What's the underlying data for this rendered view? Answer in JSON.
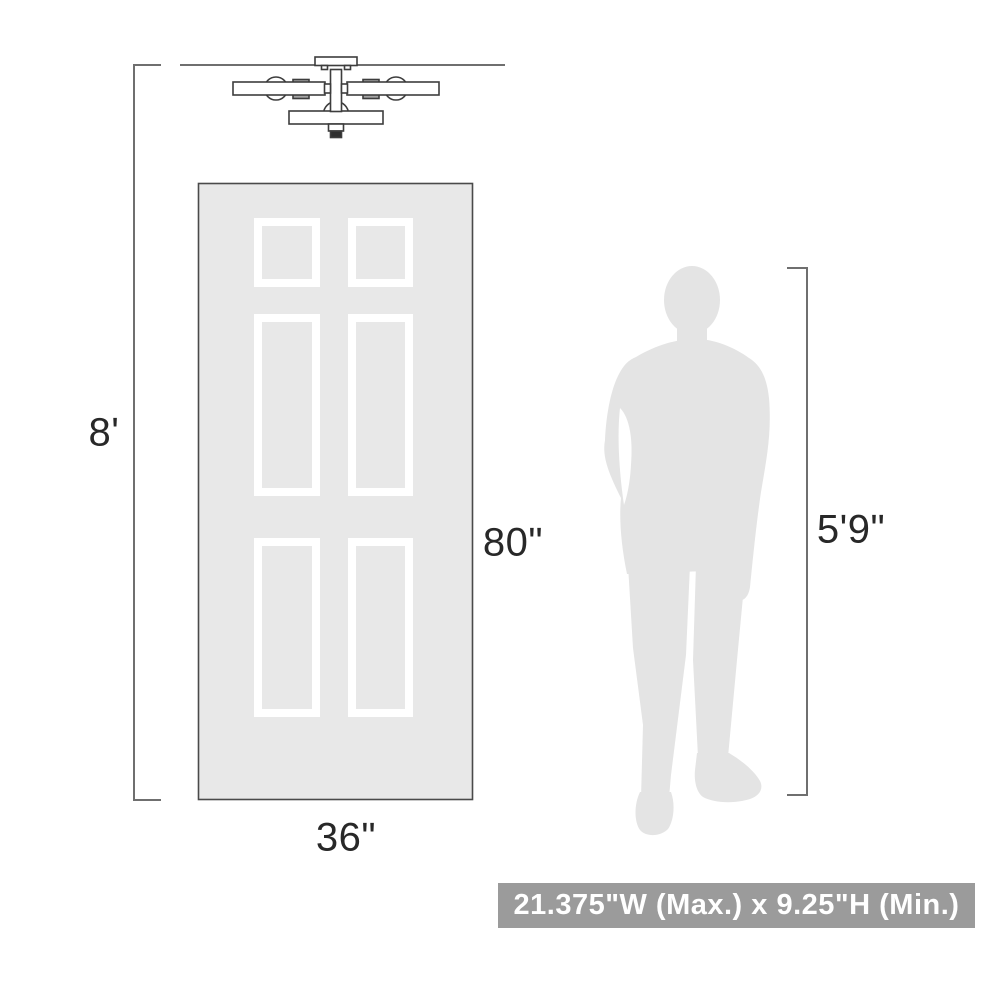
{
  "diagram": {
    "type": "product-dimensions-scale-diagram",
    "objects": [
      "ceiling-light-fixture",
      "six-panel-door",
      "man-silhouette"
    ],
    "labels": {
      "ceiling_height": "8'",
      "door_height": "80\"",
      "door_width": "36\"",
      "person_height": "5'9\""
    },
    "banner": {
      "text": "21.375\"W (Max.) x 9.25\"H (Min.)"
    }
  },
  "colors": {
    "background": "#ffffff",
    "door_fill": "#e8e8e8",
    "door_border": "#4a4a4a",
    "panel_frame": "#ffffff",
    "silhouette_fill": "#e4e4e4",
    "dimension_line": "#6f6f6f",
    "fixture_stroke": "#3d3d3d",
    "fixture_detail": "#a5a5a5",
    "fixture_dark": "#2e2e2e",
    "label_text": "#282828",
    "banner_bg": "#9b9b9b",
    "banner_text": "#ffffff"
  }
}
